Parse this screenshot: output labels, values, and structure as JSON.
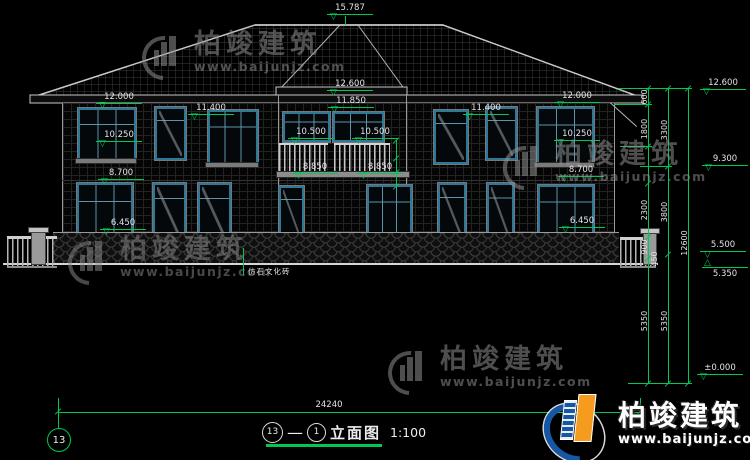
{
  "title_block": {
    "axis_start": "13",
    "dash": "—",
    "axis_end": "1",
    "name": "立面图",
    "scale": "1:100",
    "sheet_no": "13"
  },
  "note": {
    "material": "仿石文化砖"
  },
  "elevations": {
    "top": "15.787",
    "c1": "12.600",
    "c2": "11.850",
    "c3": "10.500",
    "c4": "10.500",
    "c5": "8.850",
    "c6": "8.850",
    "l1": "12.000",
    "l2": "11.400",
    "l3": "10.250",
    "l4": "8.700",
    "l5": "6.450",
    "r1": "12.000",
    "r2": "11.400",
    "r3": "10.250",
    "r4": "8.700",
    "r5": "6.450",
    "k1": "12.600",
    "k2": "9.300",
    "k3": "5.500",
    "k4": "5.350",
    "k5": "±0.000"
  },
  "dims": {
    "width_total": "24240",
    "height_total": "12600",
    "seg600": "600",
    "seg1800": "1800",
    "seg2300": "2300",
    "seg900": "900",
    "seg450": "450",
    "seg3300": "3300",
    "seg3800": "3800",
    "seg5350a": "5350",
    "seg5350b": "5350"
  },
  "watermark": {
    "brand": "柏竣建筑",
    "url": "www.baijunjz.com"
  },
  "colors": {
    "dim_green": "#00c853",
    "window_blue": "#2f7795",
    "logo_blue": "#1656a6",
    "logo_orange": "#f59b1e"
  }
}
